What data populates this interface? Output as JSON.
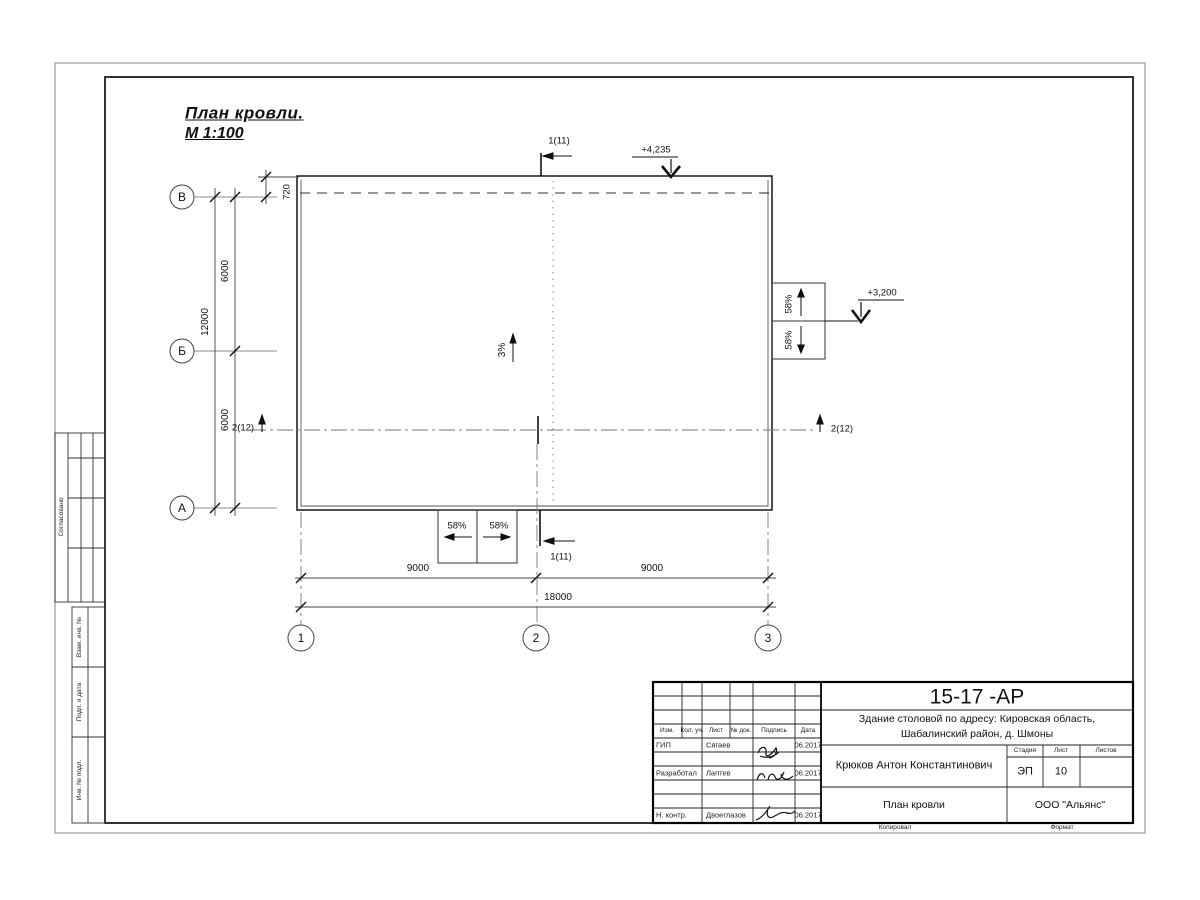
{
  "sheet": {
    "title": "План кровли.",
    "scale": "М 1:100"
  },
  "plan": {
    "axes_rows": [
      "В",
      "Б",
      "А"
    ],
    "axes_cols": [
      "1",
      "2",
      "3"
    ],
    "dims": {
      "parapet": "720",
      "row_span_1": "6000",
      "row_span_2": "6000",
      "row_total": "12000",
      "col_span_1": "9000",
      "col_span_2": "9000",
      "col_total": "18000"
    },
    "slopes": {
      "main": "3%",
      "canopy_right_top": "58%",
      "canopy_right_bottom": "58%",
      "canopy_bottom_left": "58%",
      "canopy_bottom_right": "58%"
    },
    "elevations": {
      "roof": "+4,235",
      "canopy": "+3,200"
    },
    "sections": {
      "s1": "1(11)",
      "s2": "2(12)"
    }
  },
  "margin": {
    "approve": "Согласовано",
    "replace": "Взам. инв. №",
    "sign_date": "Подп. и дата",
    "inventory": "Инв. № подл."
  },
  "titleblock": {
    "doc_number": "15-17 -АР",
    "project_line1": "Здание столовой по адресу: Кировская область,",
    "project_line2": "Шабалинский район, д. Шмоны",
    "col_headers": {
      "izm": "Изм.",
      "kol": "Кол. уч.",
      "list": "Лист",
      "doc": "№ док.",
      "sign": "Подпись",
      "date": "Дата"
    },
    "rows": [
      {
        "role": "ГИП",
        "name": "Сягаев",
        "date": "06.2017"
      },
      {
        "role": "Разработал",
        "name": "Лаптев",
        "date": "06.2017"
      },
      {
        "role": "Н. контр.",
        "name": "Двоеглазов",
        "date": "06.2017"
      }
    ],
    "author": "Крюков Антон Константинович",
    "stage_header": "Стадия",
    "sheet_header": "Лист",
    "sheets_header": "Листов",
    "stage": "ЭП",
    "sheet_no": "10",
    "drawing_title": "План кровли",
    "company": "ООО \"Альянс\"",
    "copied": "Копировал",
    "format": "Формат"
  }
}
